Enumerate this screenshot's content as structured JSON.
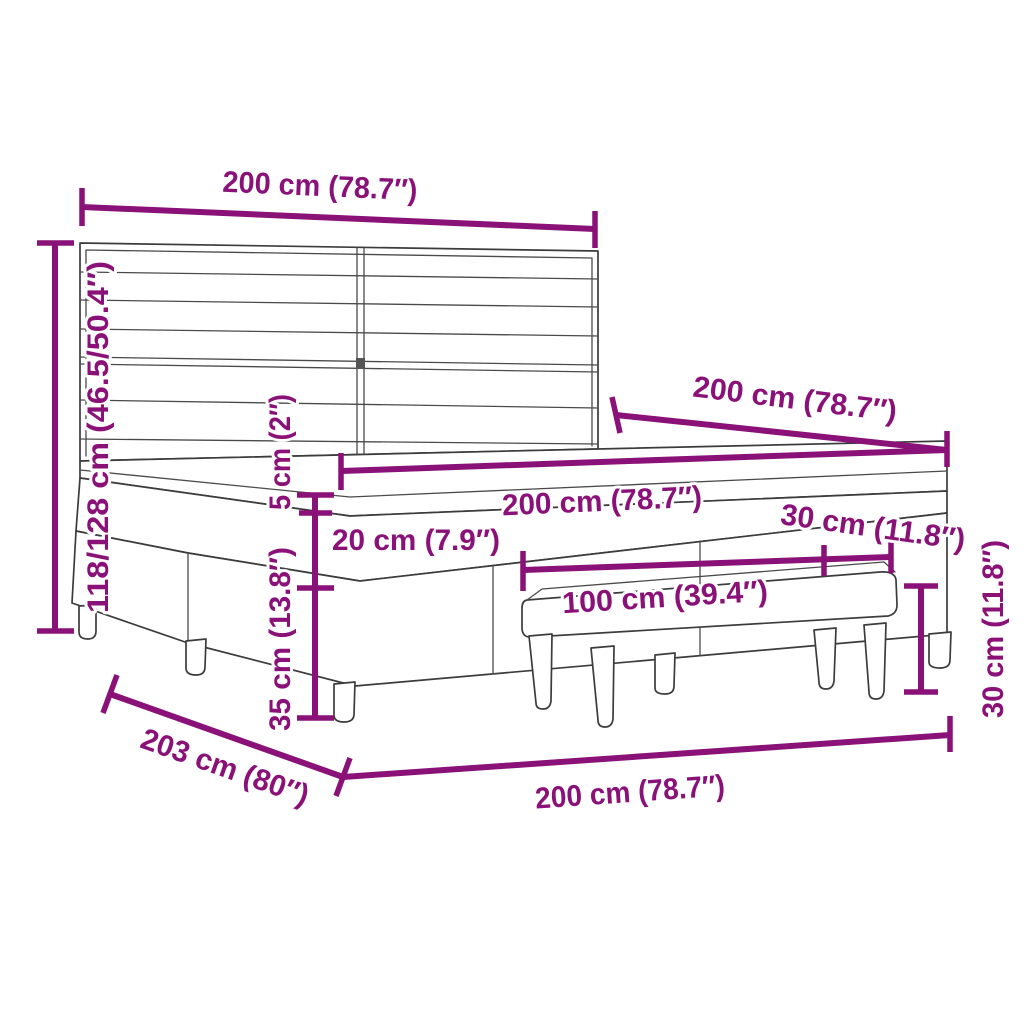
{
  "colors": {
    "dimension_accent": "#8A1177",
    "drawing_outline": "#3C3C3C",
    "background": "#FFFFFF"
  },
  "annotations": {
    "headboard_width": "200 cm (78.7″)",
    "total_height": "118/128 cm (46.5/50.4″)",
    "bed_length": "200 cm (78.7″)",
    "mattress_width": "200 cm (78.7″)",
    "topper_height": "5 cm (2″)",
    "mattress_height": "20 cm (7.9″)",
    "base_height": "35 cm (13.8″)",
    "bench_depth": "30 cm (11.8″)",
    "bench_width": "100 cm (39.4″)",
    "bench_height": "30 cm (11.8″)",
    "bed_depth": "203 cm (80″)",
    "bed_width_bottom": "200 cm (78.7″)"
  }
}
